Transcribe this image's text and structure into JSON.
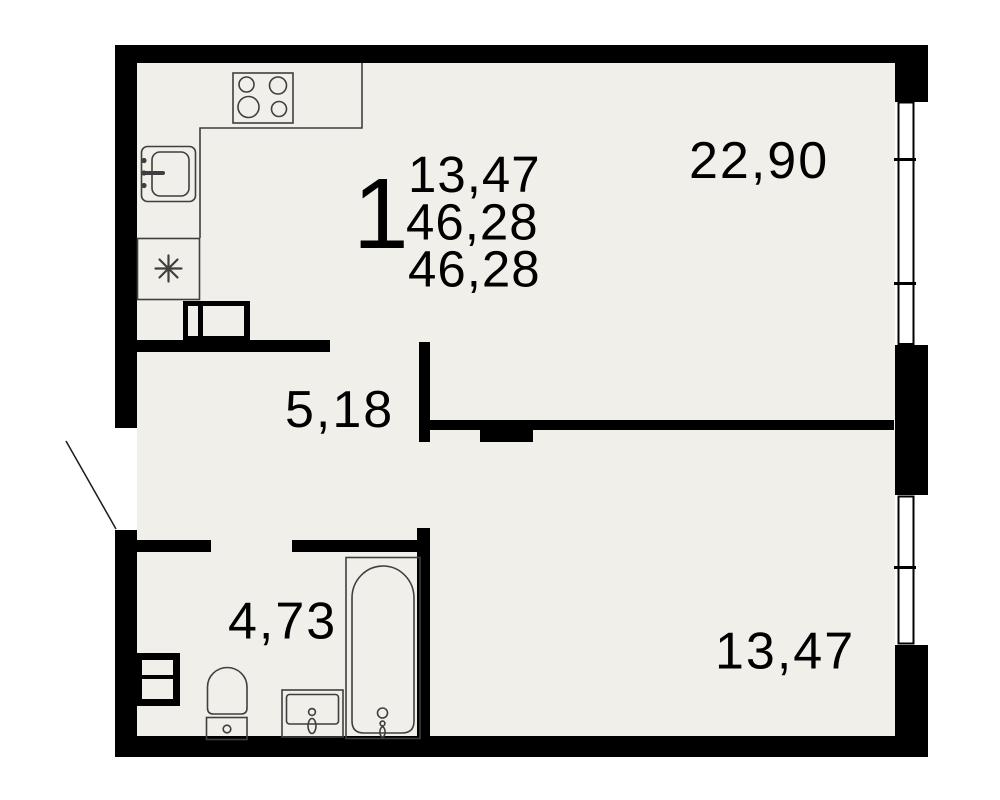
{
  "apartment": {
    "rooms_count": "1",
    "summary_areas": [
      "13,47",
      "46,28",
      "46,28"
    ],
    "room_areas": {
      "living_kitchen": "22,90",
      "hallway": "5,18",
      "bathroom": "4,73",
      "bedroom": "13,47"
    },
    "icons": [
      "stove-icon",
      "kitchen-sink-icon",
      "refrigerator-icon",
      "vent-shaft-kitchen-icon",
      "vent-shaft-bathroom-icon",
      "toilet-icon",
      "washbasin-icon",
      "bathtub-icon",
      "entrance-door-swing-icon",
      "window-top-icon",
      "window-bottom-icon"
    ],
    "colors": {
      "floor": "#f1efe9",
      "walls": "#000000",
      "fixtures": "#3f3f3f",
      "background": "#ffffff",
      "text": "#000000"
    }
  }
}
